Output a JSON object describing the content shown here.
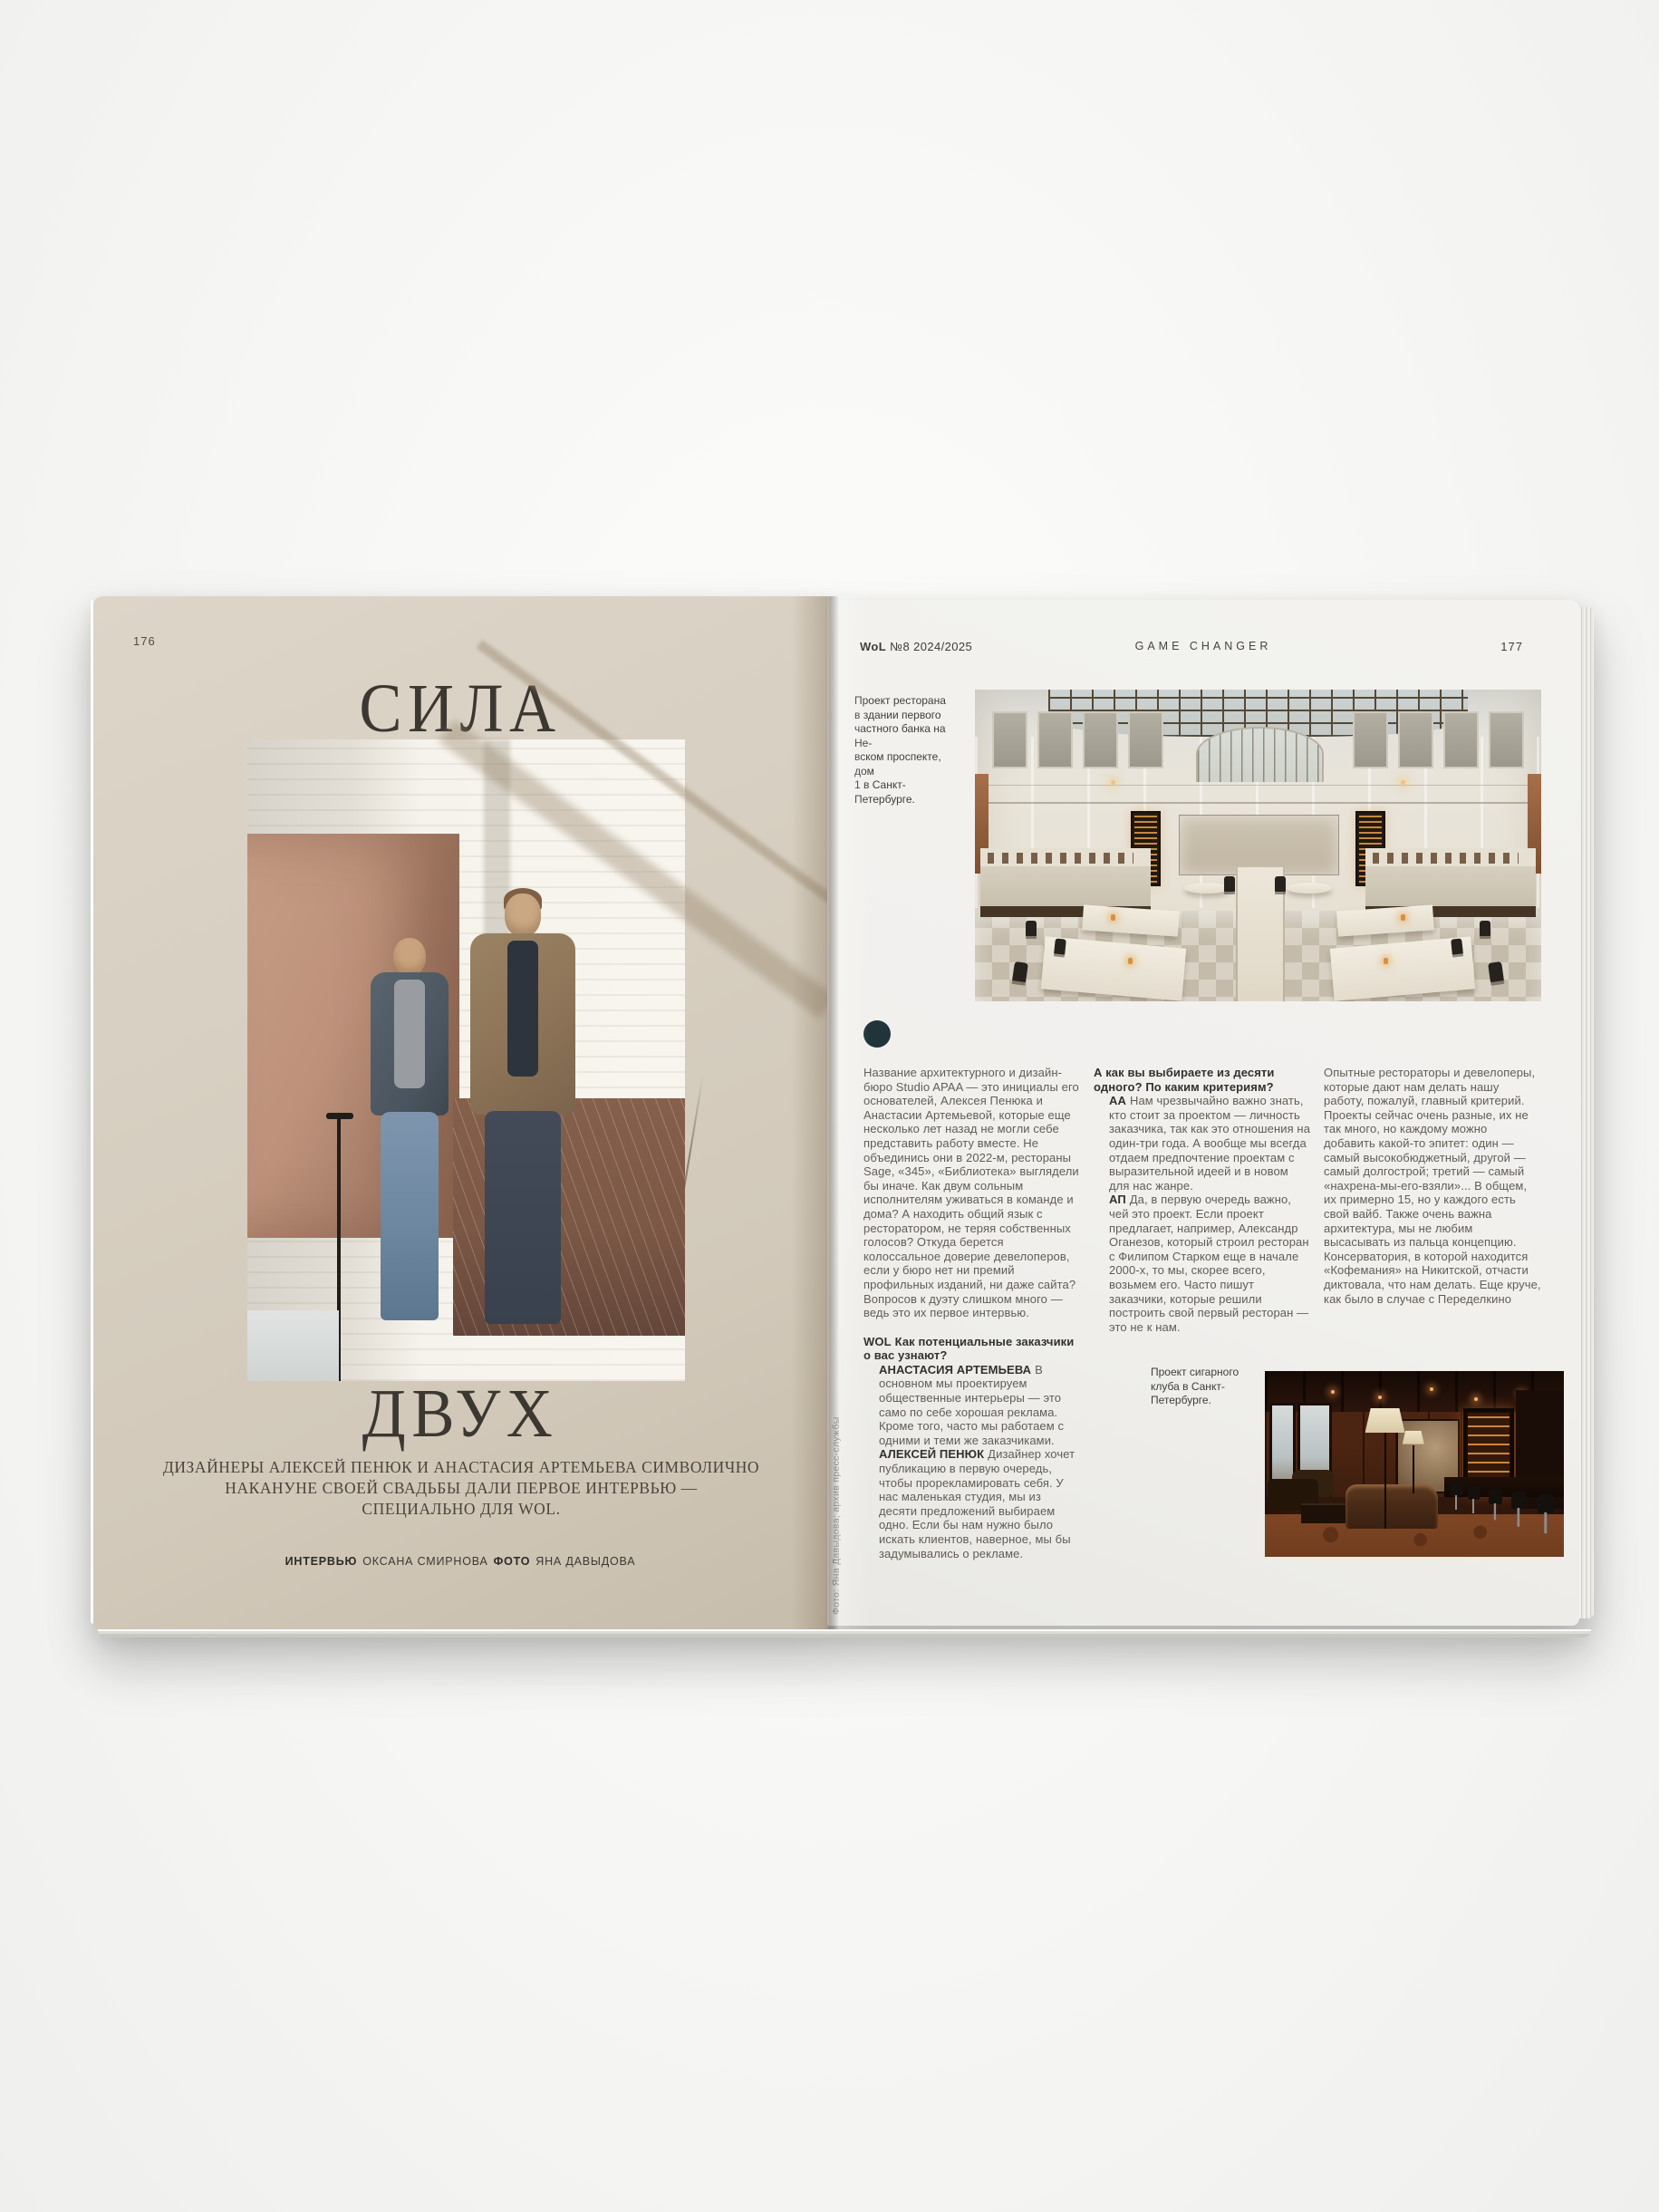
{
  "left_page": {
    "page_number": "176",
    "title_top": "СИЛА",
    "title_bottom": "ДВУХ",
    "subtitle": "ДИЗАЙНЕРЫ АЛЕКСЕЙ ПЕНЮК И АНАСТАСИЯ АРТЕМЬЕВА СИМВОЛИЧНО\nНАКАНУНЕ СВОЕЙ СВАДЬБЫ ДАЛИ ПЕРВОЕ ИНТЕРВЬЮ —\nСПЕЦИАЛЬНО ДЛЯ WOL.",
    "credit": {
      "role1": "ИНТЕРВЬЮ",
      "person1": "ОКСАНА СМИРНОВА",
      "role2": "ФОТО",
      "person2": "ЯНА ДАВЫДОВА"
    }
  },
  "right_page": {
    "header": {
      "issue_bold": "WoL",
      "issue_rest": " №8 2024/2025",
      "section": "GAME CHANGER",
      "page_number": "177"
    },
    "caption_top": "Проект ресторана\nв здании первого\nчастного банка на Не-\nвском проспекте, дом\n1 в Санкт-Петербурге.",
    "caption_bottom": "Проект сигарного\nклуба в Санкт-\nПетербурге.",
    "photo_credit_vertical": "Фото: Яна Давыдова; архив пресс-службы",
    "article": {
      "intro": "Название архитектурного и дизайн-бюро Studio APAA — это инициалы его основателей, Алексея Пенюка и Анастасии Артемьевой, которые еще несколько лет назад не могли себе представить работу вместе. Не объединись они в 2022-м, рестораны Sage, «345», «Библиотека» выглядели бы иначе. Как двум сольным исполнителям уживаться в команде и дома? А находить общий язык с ресторатором, не теряя собственных голосов? Откуда берется колоссальное доверие девелоперов, если у бюро нет ни премий профильных изданий, ни даже сайта? Вопросов к дуэту слишком много — ведь это их первое интервью.",
      "question1": {
        "label": "WOL",
        "text": "Как потенциальные заказчики о вас узнают?"
      },
      "answers1": [
        {
          "speaker": "АНАСТАСИЯ АРТЕМЬЕВА",
          "text": "В основном мы проектируем общественные интерьеры — это само по себе хорошая реклама. Кроме того, часто мы работаем с одними и теми же заказчиками."
        },
        {
          "speaker": "АЛЕКСЕЙ ПЕНЮК",
          "text": "Дизайнер хочет публикацию в первую очередь, чтобы прорекламировать себя. У нас маленькая студия, мы из десяти предложений выбираем одно. Если бы нам нужно было искать клиентов, наверное, мы бы задумывались о рекламе."
        }
      ],
      "question2": {
        "text": "А как вы выбираете из десяти одного? По каким критериям?"
      },
      "answers2": [
        {
          "speaker": "АА",
          "text": "Нам чрезвычайно важно знать, кто стоит за проектом — личность заказчика, так как это отношения на один-три года. А вообще мы всегда отдаем предпочтение проектам с выразительной идеей и в новом для нас жанре."
        },
        {
          "speaker": "АП",
          "text": "Да, в первую очередь важно, чей это проект. Если проект предлагает, например, Александр Оганезов, который строил ресторан с Филипом Старком еще в начале 2000-х, то мы, скорее всего, возьмем его. Часто пишут заказчики, которые решили построить свой первый ресторан — это не к нам."
        }
      ],
      "continuation": "Опытные рестораторы и девелоперы, которые дают нам делать нашу работу, пожалуй, главный критерий. Проекты сейчас очень разные, их не так много, но каждому можно добавить какой-то эпитет: один — самый высокобюджетный, другой — самый долгострой; третий — самый «нахрена-мы-его-взяли»... В общем, их примерно 15, но у каждого есть свой вайб. Также очень важна архитектура, мы не любим высасывать из пальца концепцию. Консерватория, в которой находится «Кофемания» на Никитской, отчасти диктовала, что нам делать. Еще круче, как было в случае с Переделкино"
    }
  },
  "colors": {
    "left_page_bg": "#d7cfc1",
    "right_page_bg": "#f1f0ed",
    "accent_circle": "#20343a",
    "title_ink": "#3b3731",
    "body_ink": "#615d56",
    "bold_ink": "#33312d"
  }
}
